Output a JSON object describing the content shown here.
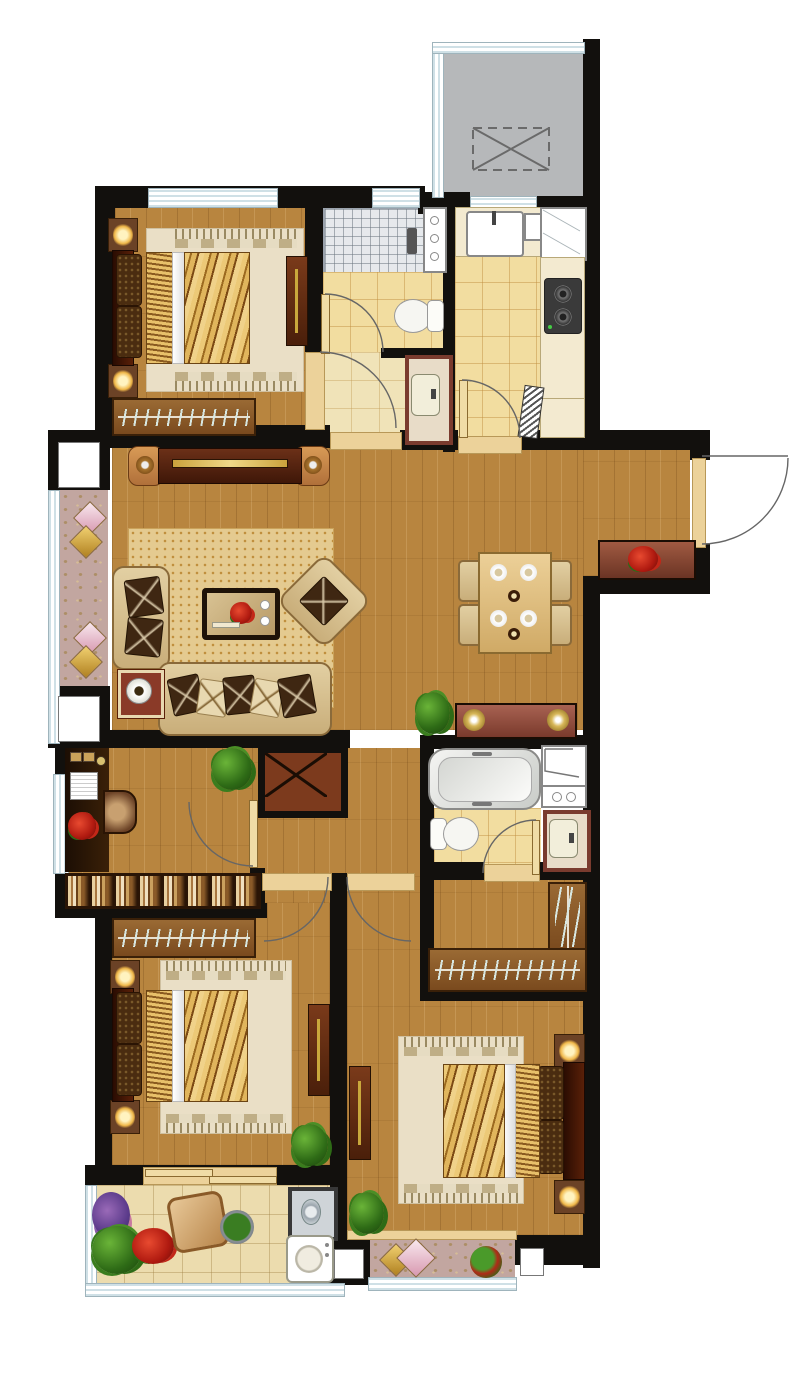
{
  "meta": {
    "kind": "apartment-floor-plan",
    "labels_visible": false,
    "orientation": "top-down render"
  },
  "palette": {
    "wall": "#12100d",
    "wood": "#b8853f",
    "tile": "#f2dda0",
    "tileline": "#d3a95f",
    "ctile": "#ecdcae",
    "shower": "#e6e9ec",
    "gray": "#b6b8ba",
    "mauve": "#c2a6a0",
    "rug": "#e4ca90",
    "bedrug": "#eadfc6",
    "darkwood": "#5f2a14",
    "redwood": "#9c5648",
    "maroon": "#3c1004",
    "tan": "#ecd29a",
    "gold": "#c9a83c",
    "plant": "#3a7d22",
    "cream": "#f3ead0",
    "white": "#ffffff",
    "arc": "#666666"
  },
  "rooms": [
    {
      "id": "service-balcony-north",
      "items": [
        "glazing-frame",
        "dashed-equipment-platform"
      ]
    },
    {
      "id": "bedroom-north",
      "items": [
        "double-bed",
        "nightstand-lamp",
        "nightstand-lamp",
        "rug",
        "wardrobe-hangers",
        "dresser"
      ]
    },
    {
      "id": "bathroom-north",
      "items": [
        "shower-area",
        "tall-cabinet",
        "toilet",
        "vanity-sink",
        "door"
      ]
    },
    {
      "id": "kitchen",
      "items": [
        "sink-counter",
        "fridge",
        "cooktop-2-burner",
        "side-counter",
        "dishwasher-door",
        "door"
      ]
    },
    {
      "id": "living-room",
      "items": [
        "tv-console",
        "area-rug",
        "loveseat",
        "armchair",
        "three-seat-sofa",
        "coffee-table-flowers",
        "lamp-side-table",
        "potted-plant"
      ]
    },
    {
      "id": "dining-room",
      "items": [
        "dining-table-4-settings",
        "chair",
        "chair",
        "chair",
        "chair",
        "sideboard-2-lamps"
      ]
    },
    {
      "id": "entry",
      "items": [
        "entry-door",
        "shoe-cabinet-flowers"
      ]
    },
    {
      "id": "west-loggia",
      "items": [
        "diamond-cushions",
        "diamond-cushions",
        "patterned-floor"
      ]
    },
    {
      "id": "study",
      "items": [
        "desk",
        "chair",
        "books",
        "flowers",
        "potted-plant",
        "bookshelf",
        "window"
      ]
    },
    {
      "id": "duct-shaft",
      "items": [
        "x-marked-shaft"
      ]
    },
    {
      "id": "bathroom-south",
      "items": [
        "bathtub",
        "cabinet",
        "washer-box",
        "toilet",
        "vanity-sink",
        "door"
      ]
    },
    {
      "id": "walk-in-closet",
      "items": [
        "l-shaped-wardrobe-hangers"
      ]
    },
    {
      "id": "bedroom-southwest",
      "items": [
        "wardrobe-hangers",
        "double-bed",
        "nightstand-lamp",
        "nightstand-lamp",
        "rug",
        "tv-board",
        "potted-plant",
        "sliding-door"
      ]
    },
    {
      "id": "bedroom-southeast",
      "items": [
        "double-bed",
        "nightstand-lamp",
        "nightstand-lamp",
        "rug",
        "tv-board",
        "potted-plant"
      ]
    },
    {
      "id": "balcony-southwest",
      "items": [
        "flower-bed",
        "lounge-chair",
        "round-planter",
        "washer",
        "laundry-sink"
      ]
    },
    {
      "id": "balcony-southeast",
      "items": [
        "diamond-cushions",
        "round-planter",
        "patterned-floor"
      ]
    }
  ],
  "door_count": 8,
  "window_count": 8
}
